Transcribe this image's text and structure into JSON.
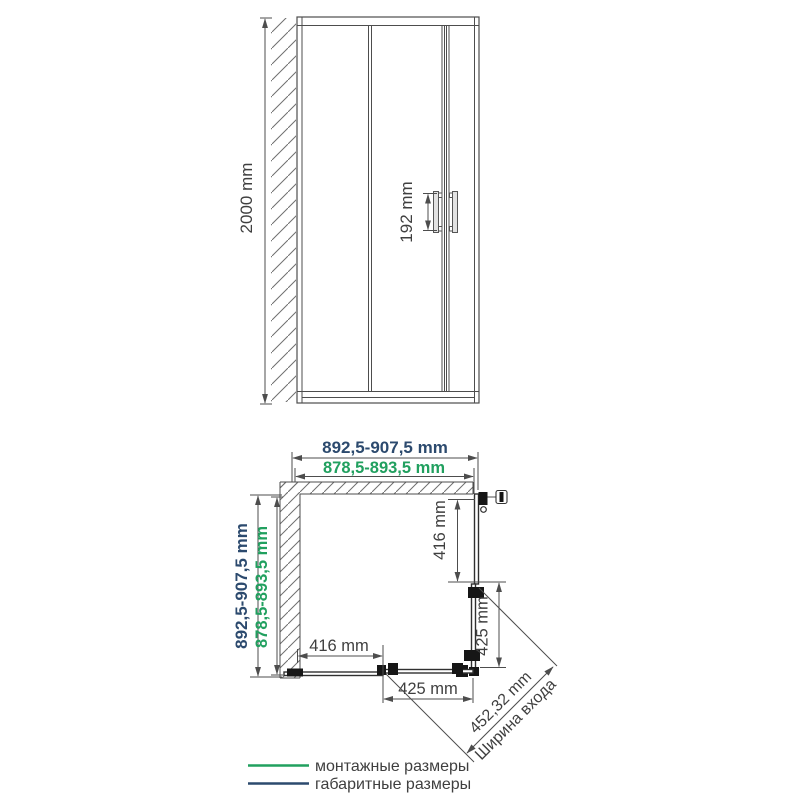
{
  "front_view": {
    "height": "2000 mm",
    "handle_height": "192 mm"
  },
  "plan_view": {
    "top": {
      "overall": "892,5-907,5 mm",
      "mounting": "878,5-893,5 mm"
    },
    "left": {
      "overall": "892,5-907,5 mm",
      "mounting": "878,5-893,5 mm"
    },
    "right": {
      "fixed_panel": "416 mm",
      "door": "425 mm"
    },
    "bottom": {
      "fixed_panel": "416 mm",
      "door": "425 mm"
    },
    "entrance": {
      "value": "452,32 mm",
      "caption": "Ширина входа"
    }
  },
  "legend": {
    "items": [
      {
        "label": "монтажные размеры",
        "color": "#21a05f"
      },
      {
        "label": "габаритные размеры",
        "color": "#2c4a6e"
      }
    ]
  },
  "colors": {
    "mounting_green": "#21a05f",
    "overall_navy": "#2c4a6e",
    "line_gray": "#4d4d4d",
    "text_gray": "#3f3f3f"
  }
}
